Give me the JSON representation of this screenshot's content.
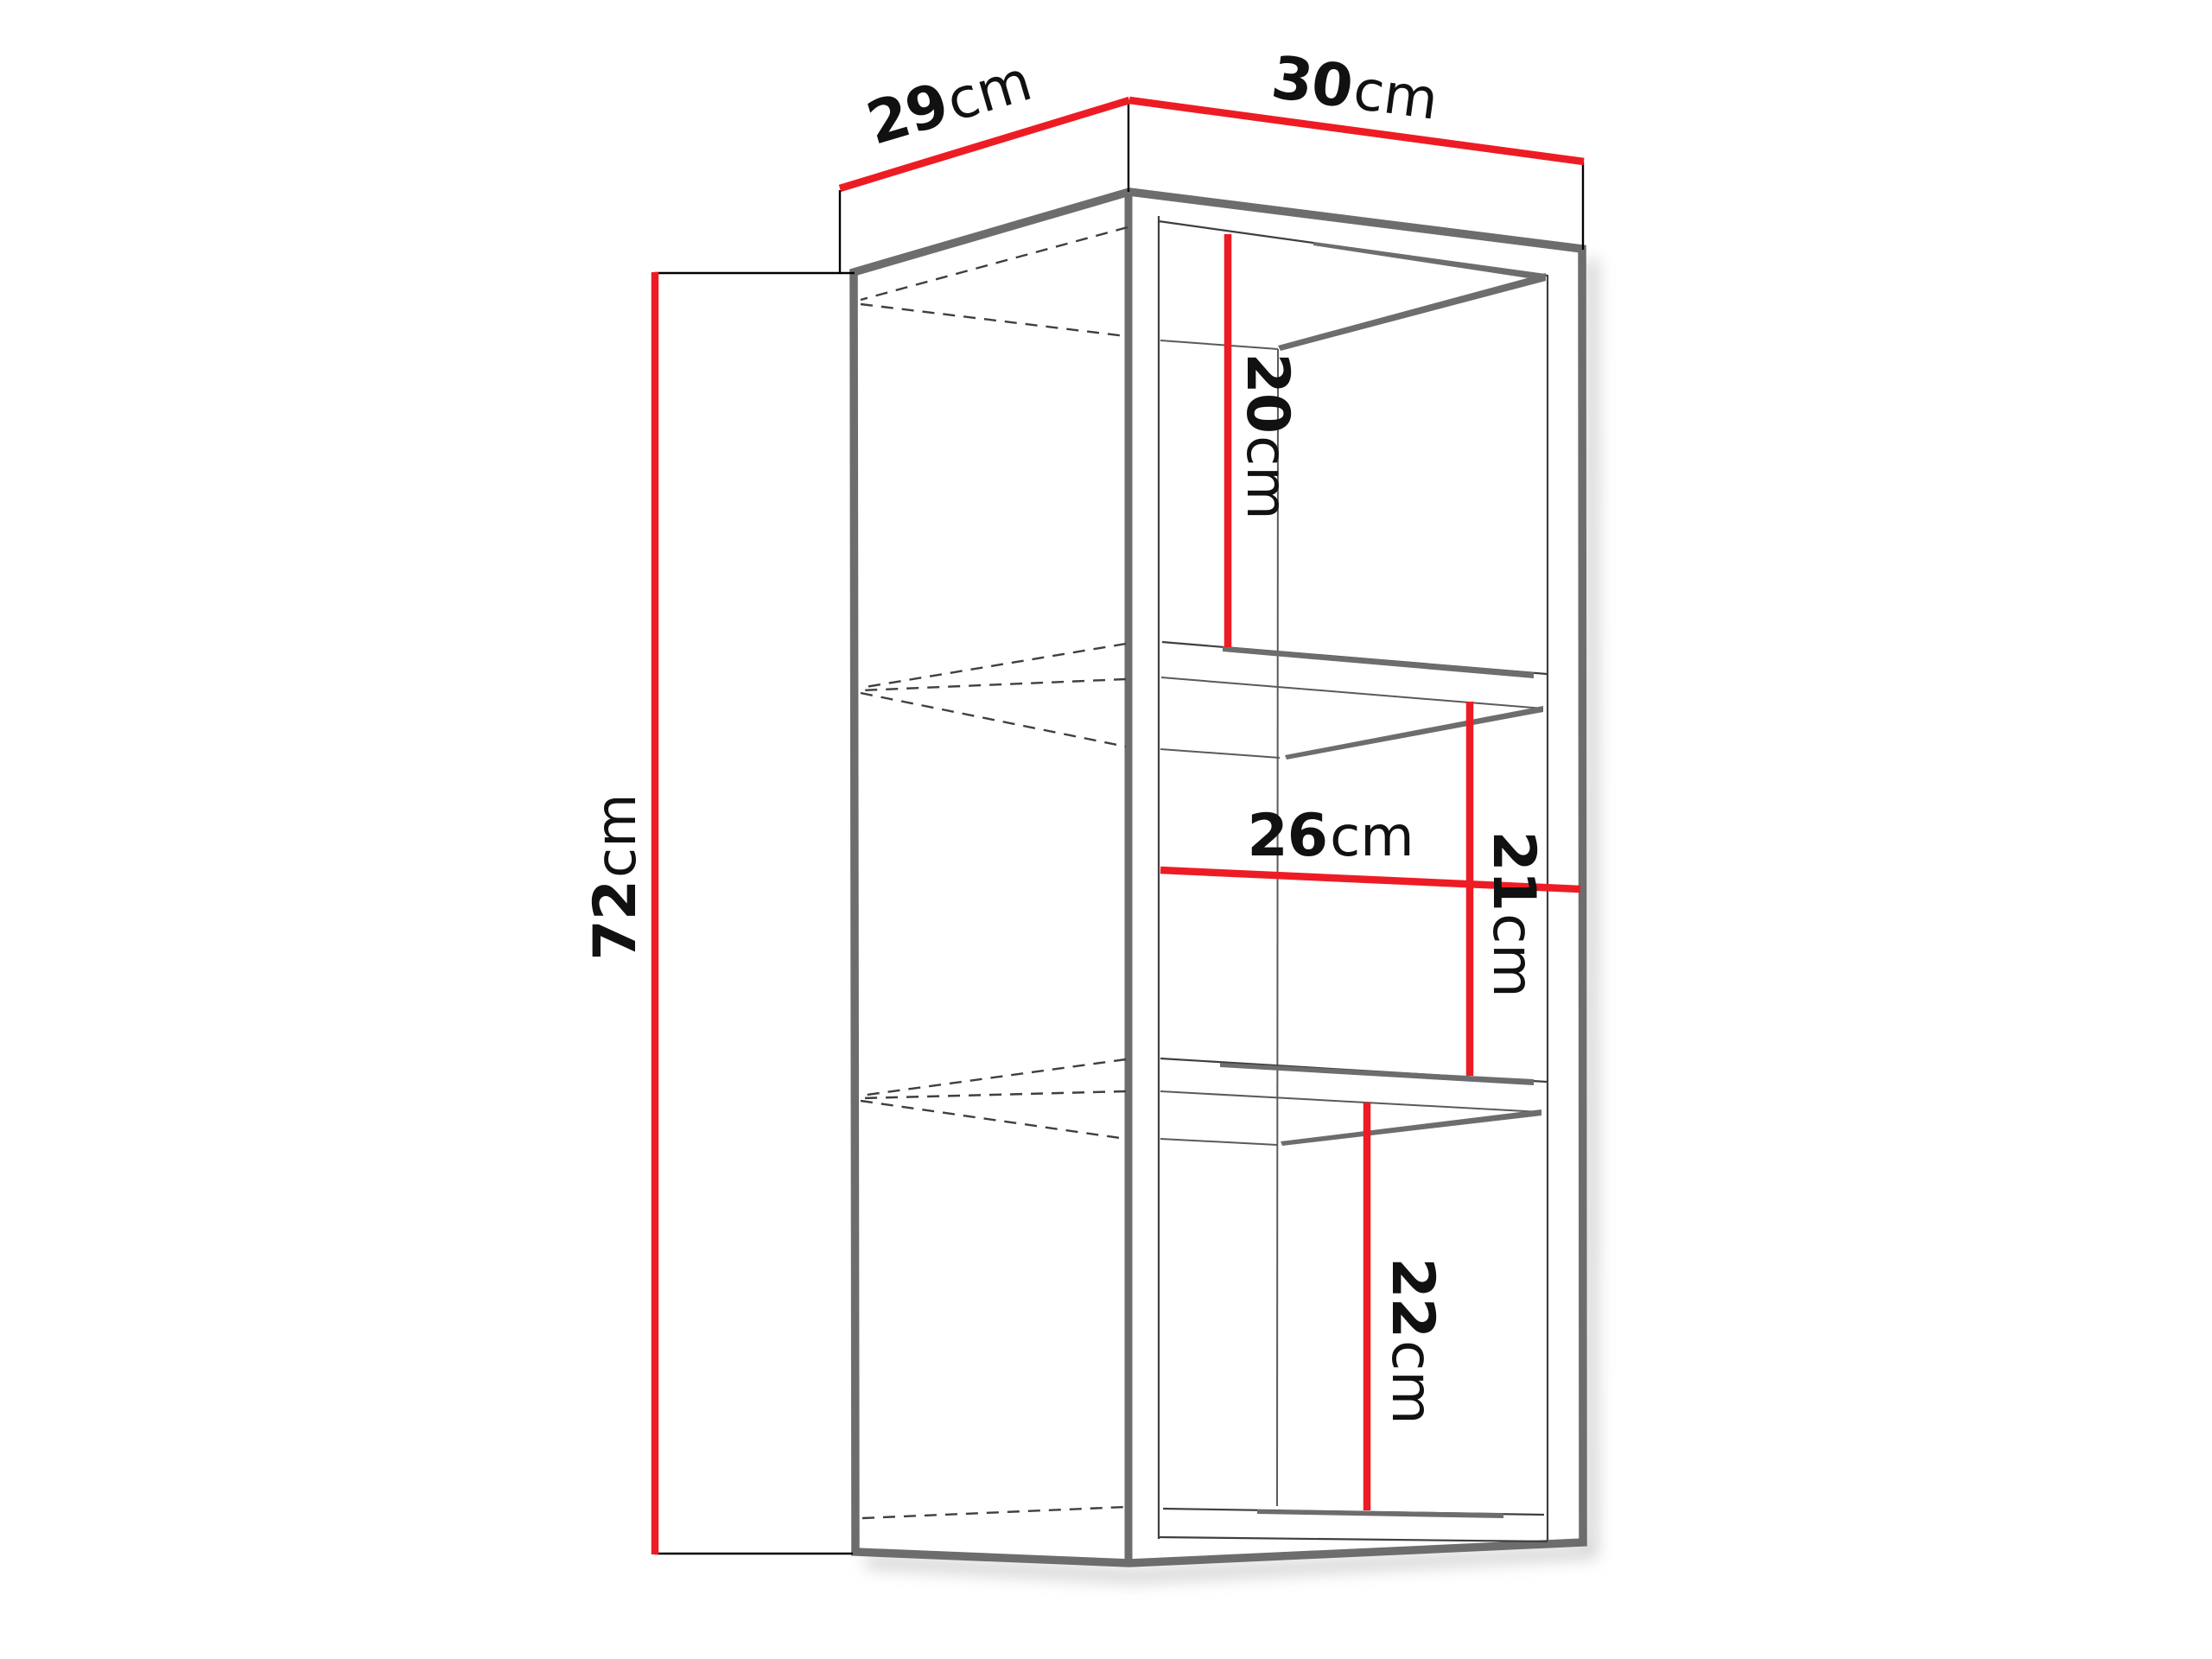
{
  "figure": {
    "kind": "furniture dimension diagram",
    "item": "wall-hung open cabinet with two shelves, three-quarter perspective line drawing",
    "units": "cm",
    "background": "#ffffff",
    "colors": {
      "dimension_line": "#ed1c24",
      "outline": "#6d6d6d",
      "detail_line": "#3f3f3f",
      "label_text": "#111111",
      "shadow": "#b0b0b0"
    },
    "labels": {
      "depth": {
        "value": "29",
        "unit": "cm"
      },
      "width": {
        "value": "30",
        "unit": "cm"
      },
      "height": {
        "value": "72",
        "unit": "cm"
      },
      "top_compartment": {
        "value": "20",
        "unit": "cm"
      },
      "interior_width": {
        "value": "26",
        "unit": "cm"
      },
      "middle_compartment": {
        "value": "21",
        "unit": "cm"
      },
      "bottom_compartment": {
        "value": "22",
        "unit": "cm"
      }
    }
  }
}
